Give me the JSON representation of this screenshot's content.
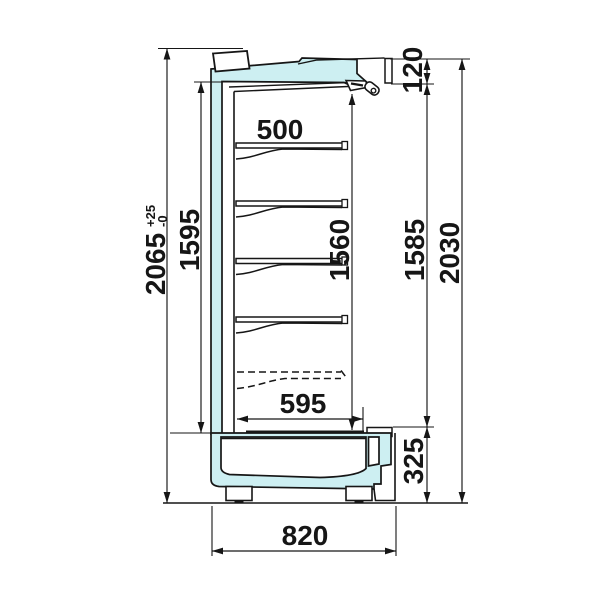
{
  "drawing": {
    "colors": {
      "background": "#ffffff",
      "line": "#161616",
      "panel_fill": "#cdeff2"
    },
    "dimensions_mm": {
      "overall_height": {
        "label": "2065",
        "tolerance_plus": "+25",
        "tolerance_minus": "-0"
      },
      "rear_interior_height": {
        "label": "1595"
      },
      "shelf_depth": {
        "label": "500"
      },
      "front_interior_height": {
        "label": "1560"
      },
      "canopy_front_height": {
        "label": "120"
      },
      "front_opening_height": {
        "label": "1585"
      },
      "body_height": {
        "label": "2030"
      },
      "bottom_shelf_depth": {
        "label": "595"
      },
      "base_height": {
        "label": "325"
      },
      "overall_depth": {
        "label": "820"
      }
    }
  }
}
